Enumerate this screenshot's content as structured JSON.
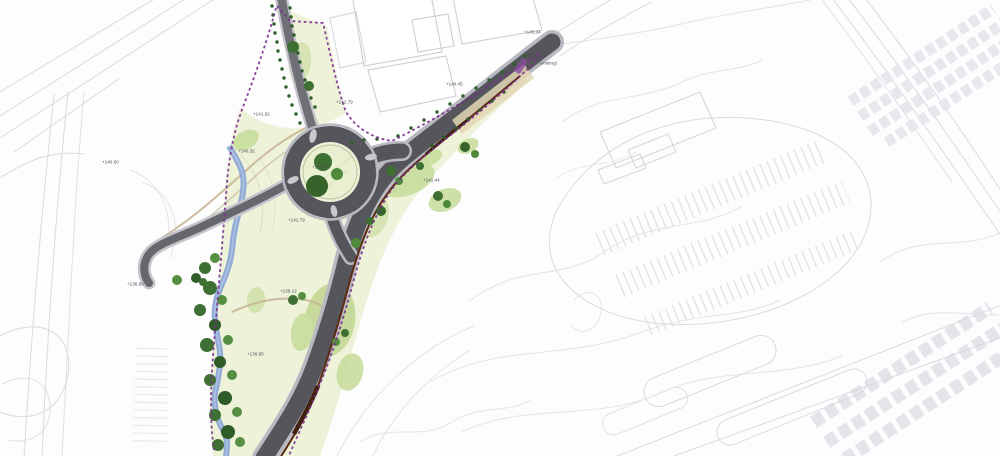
{
  "plan": {
    "labels": [
      "+145.04",
      "+140.04",
      "(tie in with existing)",
      "+140.45",
      "+142.79",
      "+141.62",
      "+140.32",
      "+140.60",
      "+141.79",
      "+139.75",
      "+141.44",
      "+139.12",
      "+136.80",
      "+136.95",
      "+140.86"
    ]
  },
  "colors": {
    "boundary_purple": "#7b2f8f",
    "road_dark": "#55565c",
    "road_casing": "#b9bac1",
    "grass_light": "#edf2d9",
    "meadow_green": "#c9dd9e",
    "tree_dark": "#3e6f33",
    "tree_mid": "#568f41",
    "stream_blue": "#8aa5d4",
    "wall_brown": "#5c2a13",
    "path_tan": "#c6b493",
    "survey_line_gray": "#d9d9e0"
  }
}
